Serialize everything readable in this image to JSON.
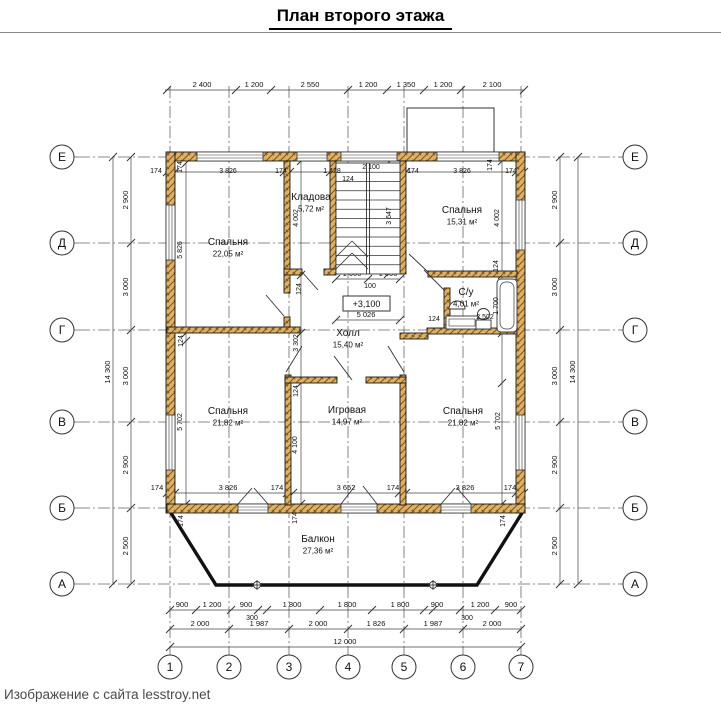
{
  "title": "План второго этажа",
  "caption": "Изображение с сайта lesstroy.net",
  "colors": {
    "text": "#111111",
    "dim": "#444444",
    "axis": "#666666",
    "wall_fill": "#dfb066",
    "wall_hatch": "#7a5a20",
    "wall_stroke": "#1a1a1a",
    "thin": "#333333",
    "balcony": "#111111"
  },
  "plan": {
    "grid": {
      "cols": [
        {
          "label": "1",
          "x": 170
        },
        {
          "label": "2",
          "x": 229
        },
        {
          "label": "3",
          "x": 289
        },
        {
          "label": "4",
          "x": 348
        },
        {
          "label": "5",
          "x": 404
        },
        {
          "label": "6",
          "x": 463
        },
        {
          "label": "7",
          "x": 521
        }
      ],
      "rows": [
        {
          "label": "Е",
          "y": 157
        },
        {
          "label": "Д",
          "y": 243
        },
        {
          "label": "Г",
          "y": 330
        },
        {
          "label": "В",
          "y": 422
        },
        {
          "label": "Б",
          "y": 508
        },
        {
          "label": "А",
          "y": 584
        }
      ],
      "col_bubble_y": 667,
      "row_bubble_left_x": 62,
      "row_bubble_right_x": 635,
      "bubble_r": 12
    },
    "rooms": [
      {
        "name": "Спальня",
        "area": "22,05 м²",
        "x": 228,
        "y": 245
      },
      {
        "name": "Кладова",
        "area": "5,72 м²",
        "x": 311,
        "y": 200
      },
      {
        "name": "Спальня",
        "area": "15,31 м²",
        "x": 462,
        "y": 213
      },
      {
        "name": "С/у",
        "area": "4,01 м²",
        "x": 466,
        "y": 295
      },
      {
        "name": "Холл",
        "area": "15,40 м²",
        "x": 348,
        "y": 336
      },
      {
        "name": "Спальня",
        "area": "21,82 м²",
        "x": 228,
        "y": 414
      },
      {
        "name": "Игровая",
        "area": "14,97 м²",
        "x": 347,
        "y": 413
      },
      {
        "name": "Спальня",
        "area": "21,82 м²",
        "x": 463,
        "y": 414
      },
      {
        "name": "Балкон",
        "area": "27,36 м²",
        "x": 318,
        "y": 542
      }
    ],
    "elevation": {
      "text": "+3,100",
      "x": 343,
      "y": 296,
      "w": 47,
      "h": 15
    },
    "walls": [
      [
        167,
        152,
        358,
        9
      ],
      [
        166,
        152,
        9,
        361
      ],
      [
        516,
        152,
        9,
        361
      ],
      [
        167,
        504,
        358,
        9
      ],
      [
        284,
        161,
        6,
        132
      ],
      [
        284,
        317,
        6,
        12
      ],
      [
        330,
        161,
        6,
        113
      ],
      [
        284,
        269,
        18,
        6
      ],
      [
        324,
        269,
        12,
        6
      ],
      [
        400,
        161,
        6,
        113
      ],
      [
        428,
        271,
        89,
        6
      ],
      [
        444,
        288,
        6,
        45
      ],
      [
        427,
        328,
        90,
        6
      ],
      [
        400,
        333,
        28,
        6
      ],
      [
        167,
        327,
        133,
        6
      ],
      [
        285,
        375,
        6,
        130
      ],
      [
        400,
        375,
        6,
        130
      ],
      [
        285,
        377,
        52,
        6
      ],
      [
        366,
        377,
        40,
        6
      ]
    ],
    "windows": [
      [
        197,
        152,
        66,
        9,
        "h"
      ],
      [
        297,
        152,
        30,
        9,
        "h"
      ],
      [
        341,
        152,
        56,
        9,
        "h"
      ],
      [
        437,
        152,
        62,
        9,
        "h"
      ],
      [
        238,
        504,
        30,
        9,
        "h"
      ],
      [
        341,
        504,
        36,
        9,
        "h"
      ],
      [
        441,
        504,
        30,
        9,
        "h"
      ],
      [
        166,
        205,
        9,
        55,
        "v"
      ],
      [
        166,
        415,
        9,
        55,
        "v"
      ],
      [
        516,
        200,
        9,
        50,
        "v"
      ],
      [
        516,
        415,
        9,
        55,
        "v"
      ]
    ],
    "doors": [
      [
        286,
        372,
        302,
        346
      ],
      [
        404,
        372,
        388,
        346
      ],
      [
        352,
        380,
        334,
        356
      ],
      [
        284,
        316,
        266,
        295
      ],
      [
        302,
        272,
        318,
        290
      ],
      [
        444,
        290,
        424,
        270
      ],
      [
        428,
        272,
        409,
        254
      ],
      [
        238,
        504,
        252,
        488
      ],
      [
        268,
        504,
        254,
        488
      ],
      [
        341,
        504,
        355,
        486
      ],
      [
        377,
        504,
        363,
        486
      ],
      [
        441,
        504,
        455,
        488
      ],
      [
        471,
        504,
        457,
        488
      ]
    ],
    "stair": {
      "x": 336,
      "y": 163,
      "w": 64,
      "h": 111,
      "treads": 11,
      "rail_x": [
        366.5,
        369.5
      ],
      "break_lines": [
        [
          336,
          269,
          352,
          253
        ],
        [
          352,
          253,
          368,
          269
        ],
        [
          336,
          257,
          352,
          241
        ],
        [
          352,
          241,
          368,
          257
        ]
      ]
    },
    "balcony": {
      "outline": [
        [
          171,
          513
        ],
        [
          216,
          585
        ],
        [
          477,
          585
        ],
        [
          522,
          513
        ]
      ],
      "markers": [
        [
          257,
          585
        ],
        [
          433,
          585
        ]
      ]
    },
    "protrusion": {
      "x": 407,
      "y": 108,
      "w": 87,
      "h": 49
    },
    "fixtures": {
      "bathtub": {
        "x": 497,
        "y": 279,
        "w": 20,
        "h": 53
      },
      "sink": {
        "cx": 457,
        "cy": 305
      },
      "counter": {
        "x": 446,
        "y": 316,
        "w": 32,
        "h": 13
      },
      "toilet": {
        "x": 476,
        "y": 320,
        "w": 15,
        "h": 9
      }
    },
    "dim_runs": [
      {
        "o": "h",
        "pos": 90,
        "from": 165,
        "to": 525,
        "ticks": [
          167,
          236,
          271,
          348,
          387,
          424,
          461,
          524
        ],
        "labels": [
          {
            "t": "2 400",
            "at": 202
          },
          {
            "t": "1 200",
            "at": 254
          },
          {
            "t": "2 550",
            "at": 310
          },
          {
            "t": "1 200",
            "at": 368
          },
          {
            "t": "1 350",
            "at": 406
          },
          {
            "t": "1 200",
            "at": 443
          },
          {
            "t": "2 100",
            "at": 492
          }
        ]
      },
      {
        "o": "h",
        "pos": 172,
        "from": 165,
        "to": 525,
        "ticks": [
          167,
          175,
          284,
          290,
          330,
          336,
          400,
          406,
          516,
          524
        ],
        "labels": []
      },
      {
        "o": "h",
        "pos": 493,
        "from": 167,
        "to": 525,
        "ticks": [
          167,
          175,
          287,
          293,
          399,
          406,
          516,
          524
        ],
        "labels": [
          {
            "t": "174",
            "at": 157
          },
          {
            "t": "3 826",
            "at": 228
          },
          {
            "t": "174",
            "at": 277
          },
          {
            "t": "3 652",
            "at": 346
          },
          {
            "t": "174",
            "at": 393
          },
          {
            "t": "3 826",
            "at": 465
          },
          {
            "t": "174",
            "at": 510
          }
        ]
      },
      {
        "o": "h",
        "pos": 610,
        "from": 170,
        "to": 521,
        "ticks": [
          170,
          196,
          231,
          258,
          267,
          320,
          372,
          424,
          433,
          460,
          495,
          521
        ],
        "labels": [
          {
            "t": "900",
            "at": 182
          },
          {
            "t": "1 200",
            "at": 212
          },
          {
            "t": "900",
            "at": 246
          },
          {
            "t": "1 800",
            "at": 292
          },
          {
            "t": "1 800",
            "at": 347
          },
          {
            "t": "1 800",
            "at": 400
          },
          {
            "t": "900",
            "at": 437
          },
          {
            "t": "1 200",
            "at": 480
          },
          {
            "t": "900",
            "at": 511
          }
        ]
      },
      {
        "o": "h",
        "pos": 629,
        "from": 170,
        "to": 521,
        "ticks": [
          170,
          229,
          289,
          348,
          404,
          463,
          521
        ],
        "labels": [
          {
            "t": "2 000",
            "at": 200
          },
          {
            "t": "1 987",
            "at": 259
          },
          {
            "t": "2 000",
            "at": 318
          },
          {
            "t": "1 826",
            "at": 376
          },
          {
            "t": "1 987",
            "at": 433
          },
          {
            "t": "2 000",
            "at": 492
          }
        ]
      },
      {
        "o": "h",
        "pos": 647,
        "from": 170,
        "to": 521,
        "ticks": [
          170,
          521
        ],
        "labels": [
          {
            "t": "12 000",
            "at": 345
          }
        ]
      },
      {
        "o": "h",
        "pos": 320,
        "from": 336,
        "to": 400,
        "ticks": [
          336,
          400
        ],
        "labels": [
          {
            "t": "5 026",
            "at": 366
          }
        ]
      },
      {
        "o": "h",
        "pos": 279,
        "from": 336,
        "to": 400,
        "ticks": [
          336,
          368,
          400
        ],
        "labels": [
          {
            "t": "1 000",
            "at": 352
          },
          {
            "t": "1 000",
            "at": 388
          }
        ]
      },
      {
        "o": "v",
        "pos": 131,
        "from": 157,
        "to": 584,
        "ticks": [
          157,
          243,
          330,
          422,
          508,
          584
        ],
        "labels": [
          {
            "t": "2 900",
            "at": 200
          },
          {
            "t": "3 000",
            "at": 287
          },
          {
            "t": "3 000",
            "at": 376
          },
          {
            "t": "2 900",
            "at": 465
          },
          {
            "t": "2 500",
            "at": 546
          }
        ]
      },
      {
        "o": "v",
        "pos": 113,
        "from": 157,
        "to": 584,
        "ticks": [
          157,
          584
        ],
        "labels": [
          {
            "t": "14 300",
            "at": 372
          }
        ]
      },
      {
        "o": "v",
        "pos": 560,
        "from": 157,
        "to": 584,
        "ticks": [
          157,
          243,
          330,
          422,
          508,
          584
        ],
        "labels": [
          {
            "t": "2 900",
            "at": 200
          },
          {
            "t": "3 000",
            "at": 287
          },
          {
            "t": "3 000",
            "at": 376
          },
          {
            "t": "2 900",
            "at": 465
          },
          {
            "t": "2 500",
            "at": 546
          }
        ]
      },
      {
        "o": "v",
        "pos": 578,
        "from": 157,
        "to": 584,
        "ticks": [
          157,
          584
        ],
        "labels": [
          {
            "t": "14 300",
            "at": 372
          }
        ]
      },
      {
        "o": "v",
        "pos": 186,
        "from": 163,
        "to": 504,
        "ticks": [
          163,
          333,
          341,
          504
        ],
        "labels": []
      },
      {
        "o": "v",
        "pos": 301,
        "from": 161,
        "to": 504,
        "ticks": [
          161,
          275,
          333,
          383,
          504
        ],
        "labels": []
      },
      {
        "o": "v",
        "pos": 502,
        "from": 161,
        "to": 504,
        "ticks": [
          161,
          275,
          333,
          383,
          504
        ],
        "labels": []
      },
      {
        "o": "v",
        "pos": 388,
        "from": 163,
        "to": 274,
        "ticks": [
          163,
          274
        ],
        "labels": []
      }
    ],
    "misc_labels": [
      {
        "t": "174",
        "x": 156,
        "y": 173
      },
      {
        "t": "3 826",
        "x": 228,
        "y": 173
      },
      {
        "t": "174",
        "x": 281,
        "y": 173
      },
      {
        "t": "1 428",
        "x": 332,
        "y": 173
      },
      {
        "t": "124",
        "x": 348,
        "y": 181
      },
      {
        "t": "2 100",
        "x": 371,
        "y": 169
      },
      {
        "t": "174",
        "x": 413,
        "y": 173
      },
      {
        "t": "3 826",
        "x": 462,
        "y": 173
      },
      {
        "t": "174",
        "x": 492,
        "y": 165,
        "r": 1
      },
      {
        "t": "174",
        "x": 511,
        "y": 173
      },
      {
        "t": "174",
        "x": 182,
        "y": 167,
        "r": 1
      },
      {
        "t": "5 826",
        "x": 182,
        "y": 250,
        "r": 1
      },
      {
        "t": "124",
        "x": 183,
        "y": 341,
        "r": 1
      },
      {
        "t": "5 702",
        "x": 182,
        "y": 422,
        "r": 1
      },
      {
        "t": "174",
        "x": 183,
        "y": 521,
        "r": 1
      },
      {
        "t": "4 002",
        "x": 298,
        "y": 218,
        "r": 1
      },
      {
        "t": "124",
        "x": 301,
        "y": 289,
        "r": 1
      },
      {
        "t": "3 302",
        "x": 298,
        "y": 343,
        "r": 1
      },
      {
        "t": "124",
        "x": 298,
        "y": 391,
        "r": 1
      },
      {
        "t": "4 100",
        "x": 297,
        "y": 445,
        "r": 1
      },
      {
        "t": "174",
        "x": 297,
        "y": 518,
        "r": 1
      },
      {
        "t": "4 002",
        "x": 499,
        "y": 218,
        "r": 1
      },
      {
        "t": "124",
        "x": 498,
        "y": 266,
        "r": 1
      },
      {
        "t": "1 700",
        "x": 498,
        "y": 306,
        "r": 1
      },
      {
        "t": "5 702",
        "x": 500,
        "y": 421,
        "r": 1
      },
      {
        "t": "174",
        "x": 505,
        "y": 521,
        "r": 1
      },
      {
        "t": "3 647",
        "x": 391,
        "y": 216,
        "r": 1
      },
      {
        "t": "100",
        "x": 370,
        "y": 288
      },
      {
        "t": "124",
        "x": 434,
        "y": 321
      },
      {
        "t": "2 502",
        "x": 485,
        "y": 319
      },
      {
        "t": "300",
        "x": 252,
        "y": 620
      },
      {
        "t": "300",
        "x": 467,
        "y": 620
      }
    ]
  }
}
